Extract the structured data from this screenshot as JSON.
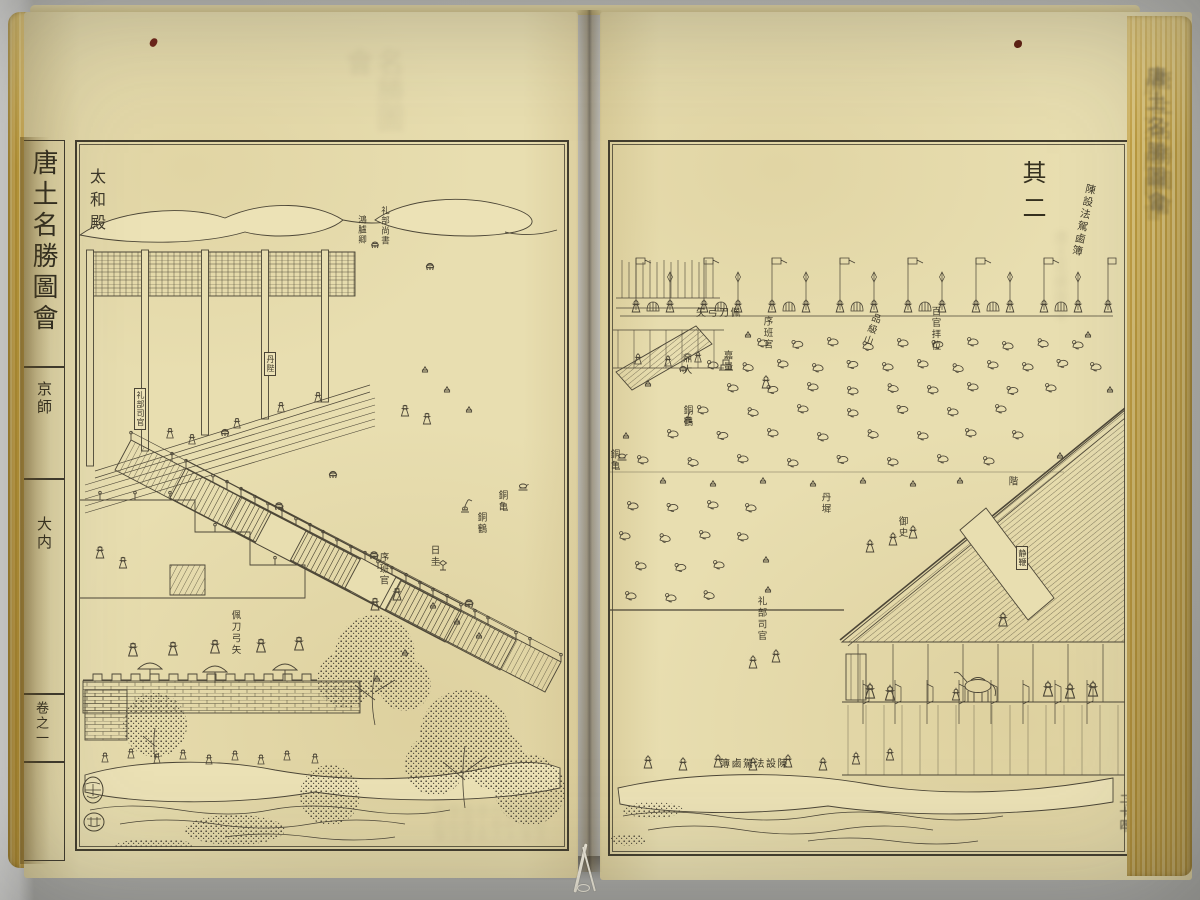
{
  "book": {
    "left_margin": {
      "series_title": "唐土名勝圖會",
      "section": "京師",
      "subsection": "大内",
      "volume": "卷之一"
    },
    "fold_edge": {
      "ghost_title": "唐土名勝圖會",
      "page_number": "二十四"
    }
  },
  "left_page": {
    "labels": {
      "hall": "太和殿",
      "honglu_qing": "鴻臚卿",
      "libu_shangshu": "礼部尚書",
      "danbi_placard": "丹陛",
      "libu_siguan_placard": "礼部司官",
      "bronze_turtle": "銅亀",
      "bronze_crane": "銅鶴",
      "sundial": "日圭",
      "xuban_guan": "序班官",
      "armed_guards": "佩刀弓矢"
    }
  },
  "right_page": {
    "part_number": "其二",
    "labels": {
      "lubu_top": "陳設法駕鹵簿",
      "armed_guards": "佩刀弓矢",
      "xuban_guan": "序班官",
      "pinji_shan": "品級山",
      "baiguan_baiwei": "百官拝位",
      "jialiang": "嘉量",
      "ding": "鼎大",
      "bronze_crane": "銅鶴",
      "bronze_turtle": "銅亀",
      "danchi": "丹墀",
      "steps": "階",
      "yushi": "御史",
      "jingbian_placard": "静鞭",
      "libu_siguan": "礼部司官",
      "lubu_bottom": "陳設法駕鹵簿"
    }
  },
  "ghost_text": {
    "left_top": "名勝圖會",
    "left_bottom": "陳設法駕鹵簿京師大内卷之唐土名勝圖會陳設法駕鹵簿",
    "right_column": "唐土名勝圖會"
  },
  "colors": {
    "paper": "#e8deb0",
    "ink": "#4c4637",
    "edge_yellow": "#d2ae50",
    "backdrop": "#b3b3af",
    "speck_red": "#6f2418"
  }
}
